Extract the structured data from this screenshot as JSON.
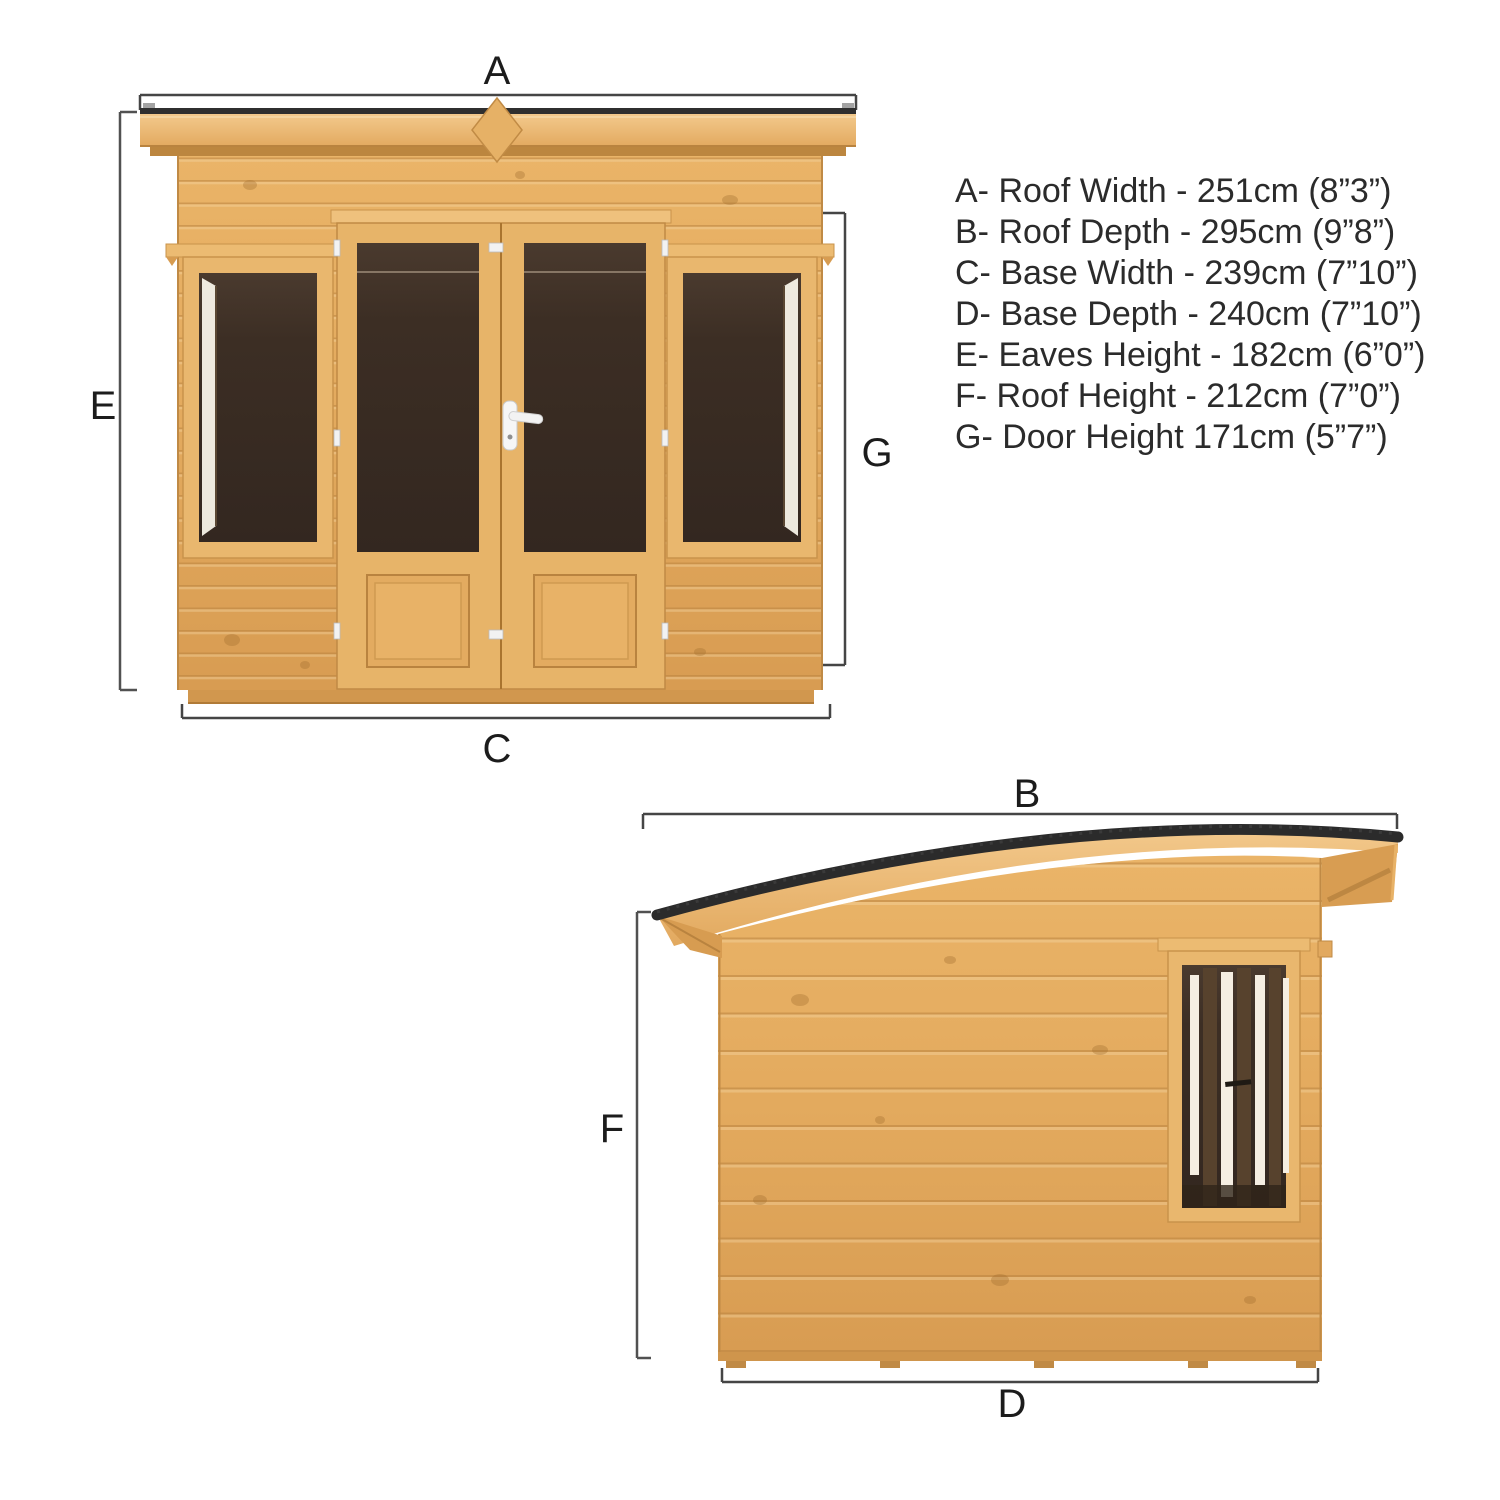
{
  "title": "Summerhouse dimensions diagram",
  "specs": {
    "lines": [
      "A- Roof Width - 251cm (8”3”)",
      "B- Roof Depth - 295cm (9”8”)",
      "C- Base Width - 239cm (7”10”)",
      "D- Base Depth - 240cm (7”10”)",
      "E- Eaves Height - 182cm (6”0”)",
      "F- Roof Height - 212cm (7”0”)",
      "G- Door Height 171cm (5”7”)"
    ]
  },
  "dimensions": [
    {
      "letter": "A",
      "name": "Roof Width",
      "value_cm": "251cm",
      "value_imperial": "8”3”"
    },
    {
      "letter": "B",
      "name": "Roof Depth",
      "value_cm": "295cm",
      "value_imperial": "9”8”"
    },
    {
      "letter": "C",
      "name": "Base Width",
      "value_cm": "239cm",
      "value_imperial": "7”10”"
    },
    {
      "letter": "D",
      "name": "Base Depth",
      "value_cm": "240cm",
      "value_imperial": "7”10”"
    },
    {
      "letter": "E",
      "name": "Eaves Height",
      "value_cm": "182cm",
      "value_imperial": "6”0”"
    },
    {
      "letter": "F",
      "name": "Roof Height",
      "value_cm": "212cm",
      "value_imperial": "7”0”"
    },
    {
      "letter": "G",
      "name": "Door Height",
      "value_cm": "171cm",
      "value_imperial": "5”7”"
    }
  ],
  "front_view": {
    "top_label": "A",
    "left_label": "E",
    "right_label": "G",
    "bottom_label": "C"
  },
  "side_view": {
    "top_label": "B",
    "left_label": "F",
    "bottom_label": "D"
  },
  "colors": {
    "background": "#ffffff",
    "dimension_line": "#454545",
    "label_text": "#1c1c1c",
    "spec_text": "#2b2b2b",
    "wood_mid": "#e2a95f",
    "wood_light": "#f0c487",
    "wood_dark": "#c08a45",
    "roof_felt": "#2b2b2b",
    "glazing_dark": "#3b2d23",
    "hardware_white": "#f4f4f4"
  }
}
